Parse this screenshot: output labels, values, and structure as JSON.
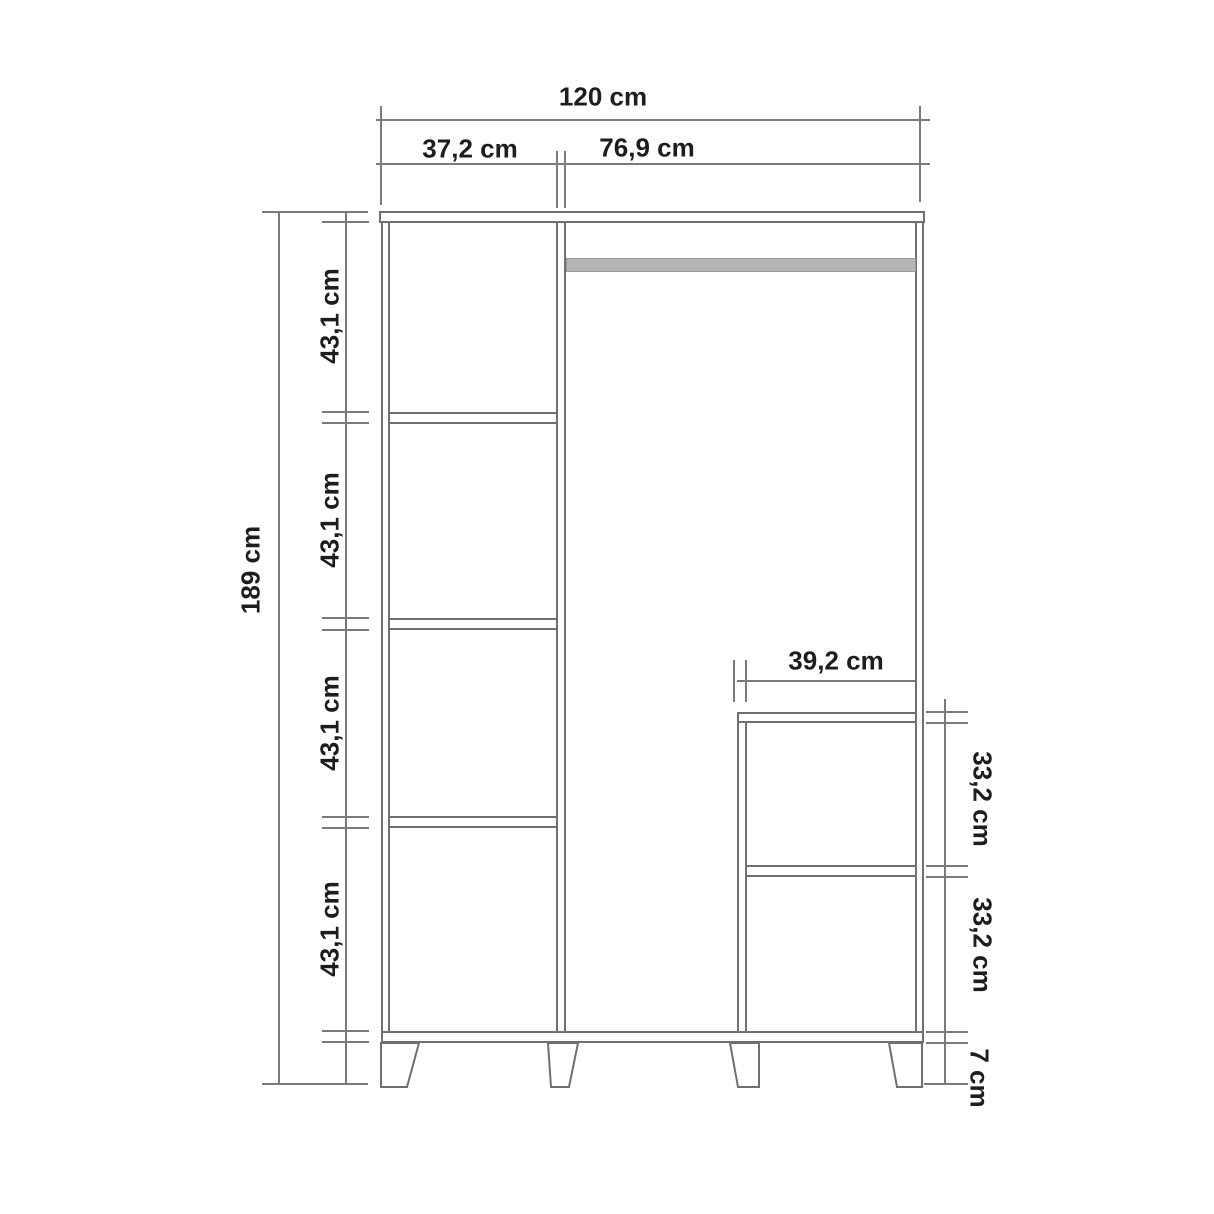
{
  "diagram": {
    "kind": "wardrobe technical dimension drawing",
    "unit": "cm",
    "colors": {
      "background": "#ffffff",
      "line": "#6f6f6f",
      "dimension_line": "#7a7a7a",
      "text": "#1d1d1d",
      "hanger_rod_fill": "#b5b5b5"
    },
    "dimensions": {
      "total_width": "120 cm",
      "left_column_width": "37,2 cm",
      "right_column_width": "76,9 cm",
      "total_height": "189 cm",
      "left_shelf_heights": [
        "43,1 cm",
        "43,1 cm",
        "43,1 cm",
        "43,1 cm"
      ],
      "inner_compartment_width": "39,2 cm",
      "inner_compartment_heights": [
        "33,2 cm",
        "33,2 cm"
      ],
      "leg_height": "7 cm"
    }
  }
}
